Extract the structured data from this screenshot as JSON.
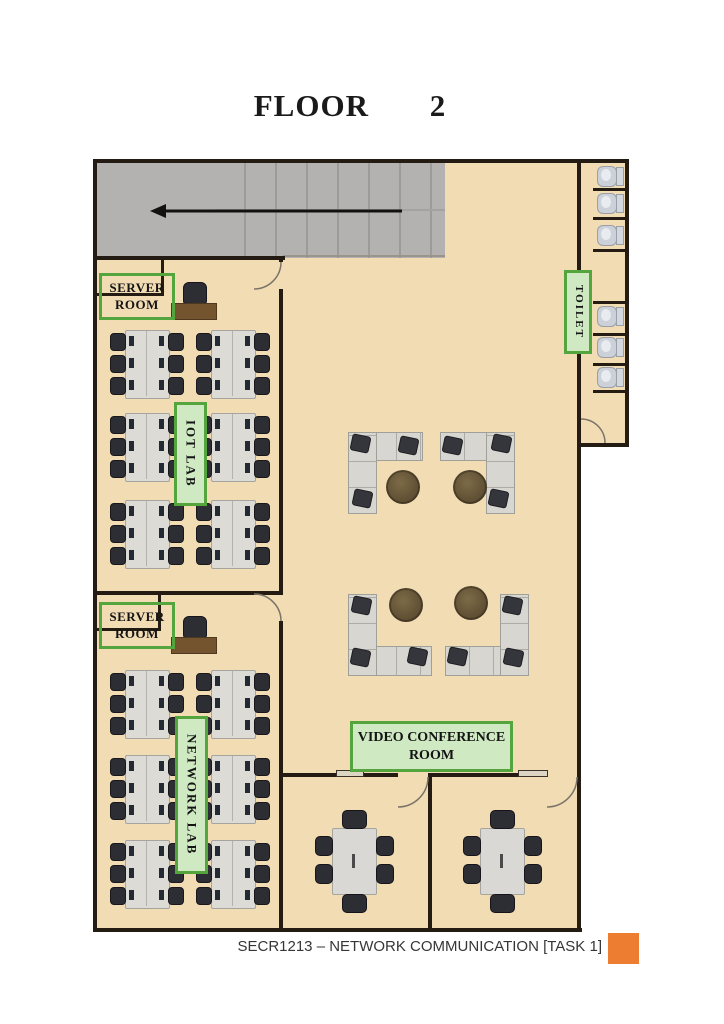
{
  "title": "FLOOR 2",
  "footer": {
    "text": "SECR1213 – NETWORK COMMUNICATION [TASK 1]",
    "accent_color": "#ED7D31"
  },
  "rooms": {
    "server_room_1": {
      "lines": [
        "SERVER",
        "ROOM"
      ]
    },
    "server_room_2": {
      "lines": [
        "SERVER",
        "ROOM"
      ]
    },
    "iot_lab": {
      "label": "IOT LAB"
    },
    "network_lab": {
      "label": "NETWORK LAB"
    },
    "toilet": {
      "label": "TOILET"
    },
    "video_conference": {
      "lines": [
        "VIDEO CONFERENCE",
        "ROOM"
      ]
    }
  },
  "stairs": {
    "arrow_direction": "left"
  },
  "colors": {
    "floor": "#f2dcb4",
    "wall": "#241c12",
    "stairs": "#b3b2b0",
    "label_border": "#55a53e",
    "label_fill": "#cfe9c2",
    "desk": "#dcdbd6",
    "chair": "#2d2d34",
    "teacher_desk": "#74532f",
    "round_table": "#6a583a",
    "sofa": "#d8d6d1",
    "accent": "#ED7D31"
  },
  "furniture": {
    "desk_clusters": [
      {
        "x": 110,
        "y": 330
      },
      {
        "x": 196,
        "y": 330
      },
      {
        "x": 110,
        "y": 413
      },
      {
        "x": 196,
        "y": 413
      },
      {
        "x": 110,
        "y": 500
      },
      {
        "x": 196,
        "y": 500
      },
      {
        "x": 110,
        "y": 670
      },
      {
        "x": 196,
        "y": 670
      },
      {
        "x": 110,
        "y": 755
      },
      {
        "x": 196,
        "y": 755
      },
      {
        "x": 110,
        "y": 840
      },
      {
        "x": 196,
        "y": 840
      }
    ],
    "teacher_stations": [
      {
        "x": 171,
        "y": 282
      },
      {
        "x": 171,
        "y": 616
      }
    ],
    "sofas": [
      {
        "x": 348,
        "y": 432,
        "w": 73,
        "h": 80,
        "corner": "tl"
      },
      {
        "x": 440,
        "y": 432,
        "w": 73,
        "h": 80,
        "corner": "tr"
      },
      {
        "x": 348,
        "y": 594,
        "w": 82,
        "h": 80,
        "corner": "bl"
      },
      {
        "x": 445,
        "y": 594,
        "w": 82,
        "h": 80,
        "corner": "br"
      }
    ],
    "round_tables": [
      {
        "x": 386,
        "y": 470
      },
      {
        "x": 453,
        "y": 470
      },
      {
        "x": 389,
        "y": 588
      },
      {
        "x": 454,
        "y": 586
      }
    ],
    "conference_tables": [
      {
        "x": 332,
        "y": 828
      },
      {
        "x": 480,
        "y": 828
      }
    ],
    "toilet_dividers": [
      188,
      217,
      249,
      301,
      333,
      363,
      390
    ],
    "toilet_units": [
      166,
      193,
      225,
      306,
      337,
      367
    ]
  }
}
